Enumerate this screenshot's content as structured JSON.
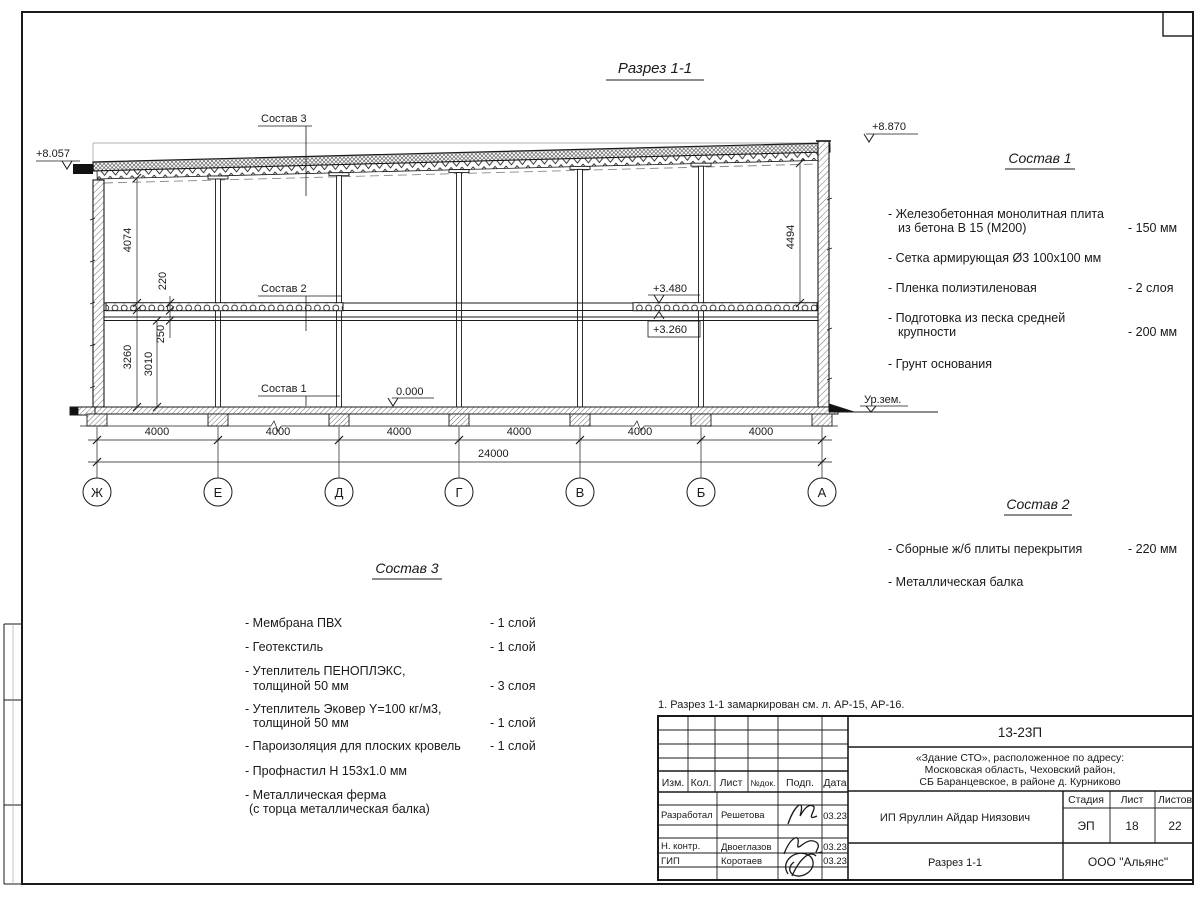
{
  "sheet": {
    "section_title": "Разрез 1-1",
    "note": "1. Разрез 1-1 замаркирован см. л. АР-15, АР-16."
  },
  "drawing": {
    "levels": {
      "roof_left": "+8.057",
      "roof_right": "+8.870",
      "slab_top": "+3.480",
      "slab_bottom": "+3.260",
      "floor": "0.000",
      "ground": "Ур.зем."
    },
    "vdims": {
      "upper_left": "4074",
      "slab": "220",
      "beam": "250",
      "first_floor": "3260",
      "clear_height": "3010",
      "upper_right": "4494"
    },
    "bay_dims": [
      "4000",
      "4000",
      "4000",
      "4000",
      "4000",
      "4000"
    ],
    "total_dim": "24000",
    "axes": [
      "Ж",
      "Е",
      "Д",
      "Г",
      "В",
      "Б",
      "А"
    ],
    "callouts": {
      "c1": "Состав 1",
      "c2": "Состав 2",
      "c3": "Состав 3"
    }
  },
  "sostav1": {
    "title": "Состав 1",
    "items": [
      {
        "l1": "- Железобетонная  монолитная плита",
        "l2": "из бетона В 15 (М200)",
        "value": "- 150 мм"
      },
      {
        "l1": "- Сетка армирующая Ø3 100х100 мм",
        "l2": "",
        "value": ""
      },
      {
        "l1": "- Пленка полиэтиленовая",
        "l2": "",
        "value": "-  2 слоя"
      },
      {
        "l1": "- Подготовка из песка средней",
        "l2": "крупности",
        "value": "- 200 мм"
      },
      {
        "l1": "- Грунт основания",
        "l2": "",
        "value": ""
      }
    ]
  },
  "sostav2": {
    "title": "Состав 2",
    "items": [
      {
        "l1": "- Сборные ж/б плиты перекрытия",
        "value": "- 220 мм"
      },
      {
        "l1": "- Металлическая  балка",
        "value": ""
      }
    ]
  },
  "sostav3": {
    "title": "Состав 3",
    "items": [
      {
        "l1": "- Мембрана ПВХ",
        "l2": "",
        "value": "- 1 слой"
      },
      {
        "l1": "- Геотекстиль",
        "l2": "",
        "value": "- 1 слой"
      },
      {
        "l1": "- Утеплитель ПЕНОПЛЭКС,",
        "l2": "толщиной 50 мм",
        "value": "- 3 слоя"
      },
      {
        "l1": "- Утеплитель Эковер Y=100 кг/м3,",
        "l2": "толщиной 50 мм",
        "value": "- 1 слой"
      },
      {
        "l1": "- Пароизоляция для плоских кровель",
        "l2": "",
        "value": "- 1 слой"
      },
      {
        "l1": "- Профнастил Н 153х1.0 мм",
        "l2": "",
        "value": ""
      },
      {
        "l1": "- Металлическая ферма",
        "l2": "(с торца металлическая балка)",
        "value": ""
      }
    ]
  },
  "title_block": {
    "doc_number": "13-23П",
    "project_line1": "«Здание СТО», расположенное по адресу:",
    "project_line2": "Московская область, Чеховский район,",
    "project_line3": "СБ Баранцевское, в районе д. Курниково",
    "client": "ИП Яруллин Айдар Ниязович",
    "sheet_title": "Разрез 1-1",
    "company": "ООО \"Альянс\"",
    "stage_label": "Стадия",
    "sheet_label": "Лист",
    "sheets_label": "Листов",
    "stage": "ЭП",
    "sheet": "18",
    "sheets": "22",
    "header_cols": [
      "Изм.",
      "Кол.",
      "Лист",
      "№док.",
      "Подп.",
      "Дата"
    ],
    "rows": [
      {
        "role": "Разработал",
        "name": "Решетова",
        "date": "03.23"
      },
      {
        "role": "Н. контр.",
        "name": "Двоеглазов",
        "date": "03.23"
      },
      {
        "role": "ГИП",
        "name": "Коротаев",
        "date": "03.23"
      }
    ]
  }
}
